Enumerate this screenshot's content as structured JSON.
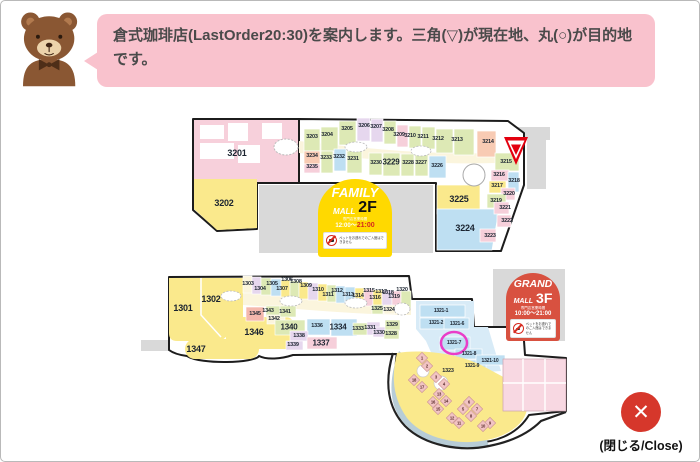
{
  "assistant": {
    "message": "倉式珈琲店(LastOrder20:30)を案内します。三角(▽)が現在地、丸(○)が目的地です。"
  },
  "floor2": {
    "badge": {
      "name": "FAMILY",
      "mall": "MALL",
      "floor": "2F",
      "hours_label": "専門店営業時間",
      "hours_open": "12:00〜",
      "hours_close": "21:00",
      "pet_notice": "ペットをお連れでのご入館はできません"
    },
    "shops": {
      "s3201": "3201",
      "s3202": "3202",
      "s3203": "3203",
      "s3204": "3204",
      "s3205": "3205",
      "s3206": "3206",
      "s3207": "3207",
      "s3208": "3208",
      "s3209": "3209",
      "s3210": "3210",
      "s3211": "3211",
      "s3212": "3212",
      "s3213": "3213",
      "s3214": "3214",
      "s3215": "3215",
      "s3216": "3216",
      "s3217": "3217",
      "s3218": "3218",
      "s3219": "3219",
      "s3220": "3220",
      "s3221": "3221",
      "s3222": "3222",
      "s3223": "3223",
      "s3224": "3224",
      "s3225": "3225",
      "s3226": "3226",
      "s3227": "3227",
      "s3228": "3228",
      "s3229": "3229",
      "s3230": "3230",
      "s3231": "3231",
      "s3232": "3232",
      "s3233": "3233",
      "s3234": "3234",
      "s3235": "3235"
    }
  },
  "floor3": {
    "badge": {
      "name": "GRAND",
      "mall": "MALL",
      "floor": "3F",
      "hours_label": "専門店営業時間",
      "hours_open": "10:00〜",
      "hours_close": "21:00",
      "pet_notice": "ペットをお連れでのご入館はできません"
    },
    "shops": {
      "s1301": "1301",
      "s1302": "1302",
      "s1303": "1303",
      "s1304": "1304",
      "s1305": "1305",
      "s1306": "1306",
      "s1307": "1307",
      "s1308": "1308",
      "s1309": "1309",
      "s1310": "1310",
      "s1311": "1311",
      "s1312": "1312",
      "s1313": "1313",
      "s1314": "1314",
      "s1315": "1315",
      "s1316": "1316",
      "s1317": "1317",
      "s1318": "1318",
      "s1319": "1319",
      "s1320": "1320",
      "s1321_1": "1321-1",
      "s1321_2": "1321-2",
      "s1321_6": "1321-6",
      "s1321_7": "1321-7",
      "s1321_8": "1321-8",
      "s1321_9": "1321-9",
      "s1321_10": "1321-10",
      "s1323": "1323",
      "s1324": "1324",
      "s1325": "1325",
      "s1328": "1328",
      "s1329": "1329",
      "s1330": "1330",
      "s1331": "1331",
      "s1333": "1333",
      "s1334": "1334",
      "s1336": "1336",
      "s1337": "1337",
      "s1338": "1338",
      "s1339": "1339",
      "s1340": "1340",
      "s1341": "1341",
      "s1342": "1342",
      "s1343": "1343",
      "s1345": "1345",
      "s1346": "1346",
      "s1347": "1347"
    },
    "stalls": {
      "st1": "1",
      "st2": "2",
      "st3": "3",
      "st4": "4",
      "st5": "5",
      "st6": "6",
      "st7": "7",
      "st8": "8",
      "st9": "9",
      "st10": "10",
      "st11": "11",
      "st12": "12",
      "st13": "13",
      "st14": "14",
      "st15": "15",
      "st16": "16",
      "st17": "17",
      "st18": "18"
    }
  },
  "close": {
    "glyph": "✕",
    "label": "(閉じる/Close)"
  },
  "colors": {
    "bubble_pink": "#f9c2cd",
    "badge_yellow": "#ffd900",
    "badge_red": "#d85140",
    "close_red": "#d6372b",
    "marker_current_red": "#e3000f",
    "marker_destination_magenta": "#e93dc8"
  }
}
